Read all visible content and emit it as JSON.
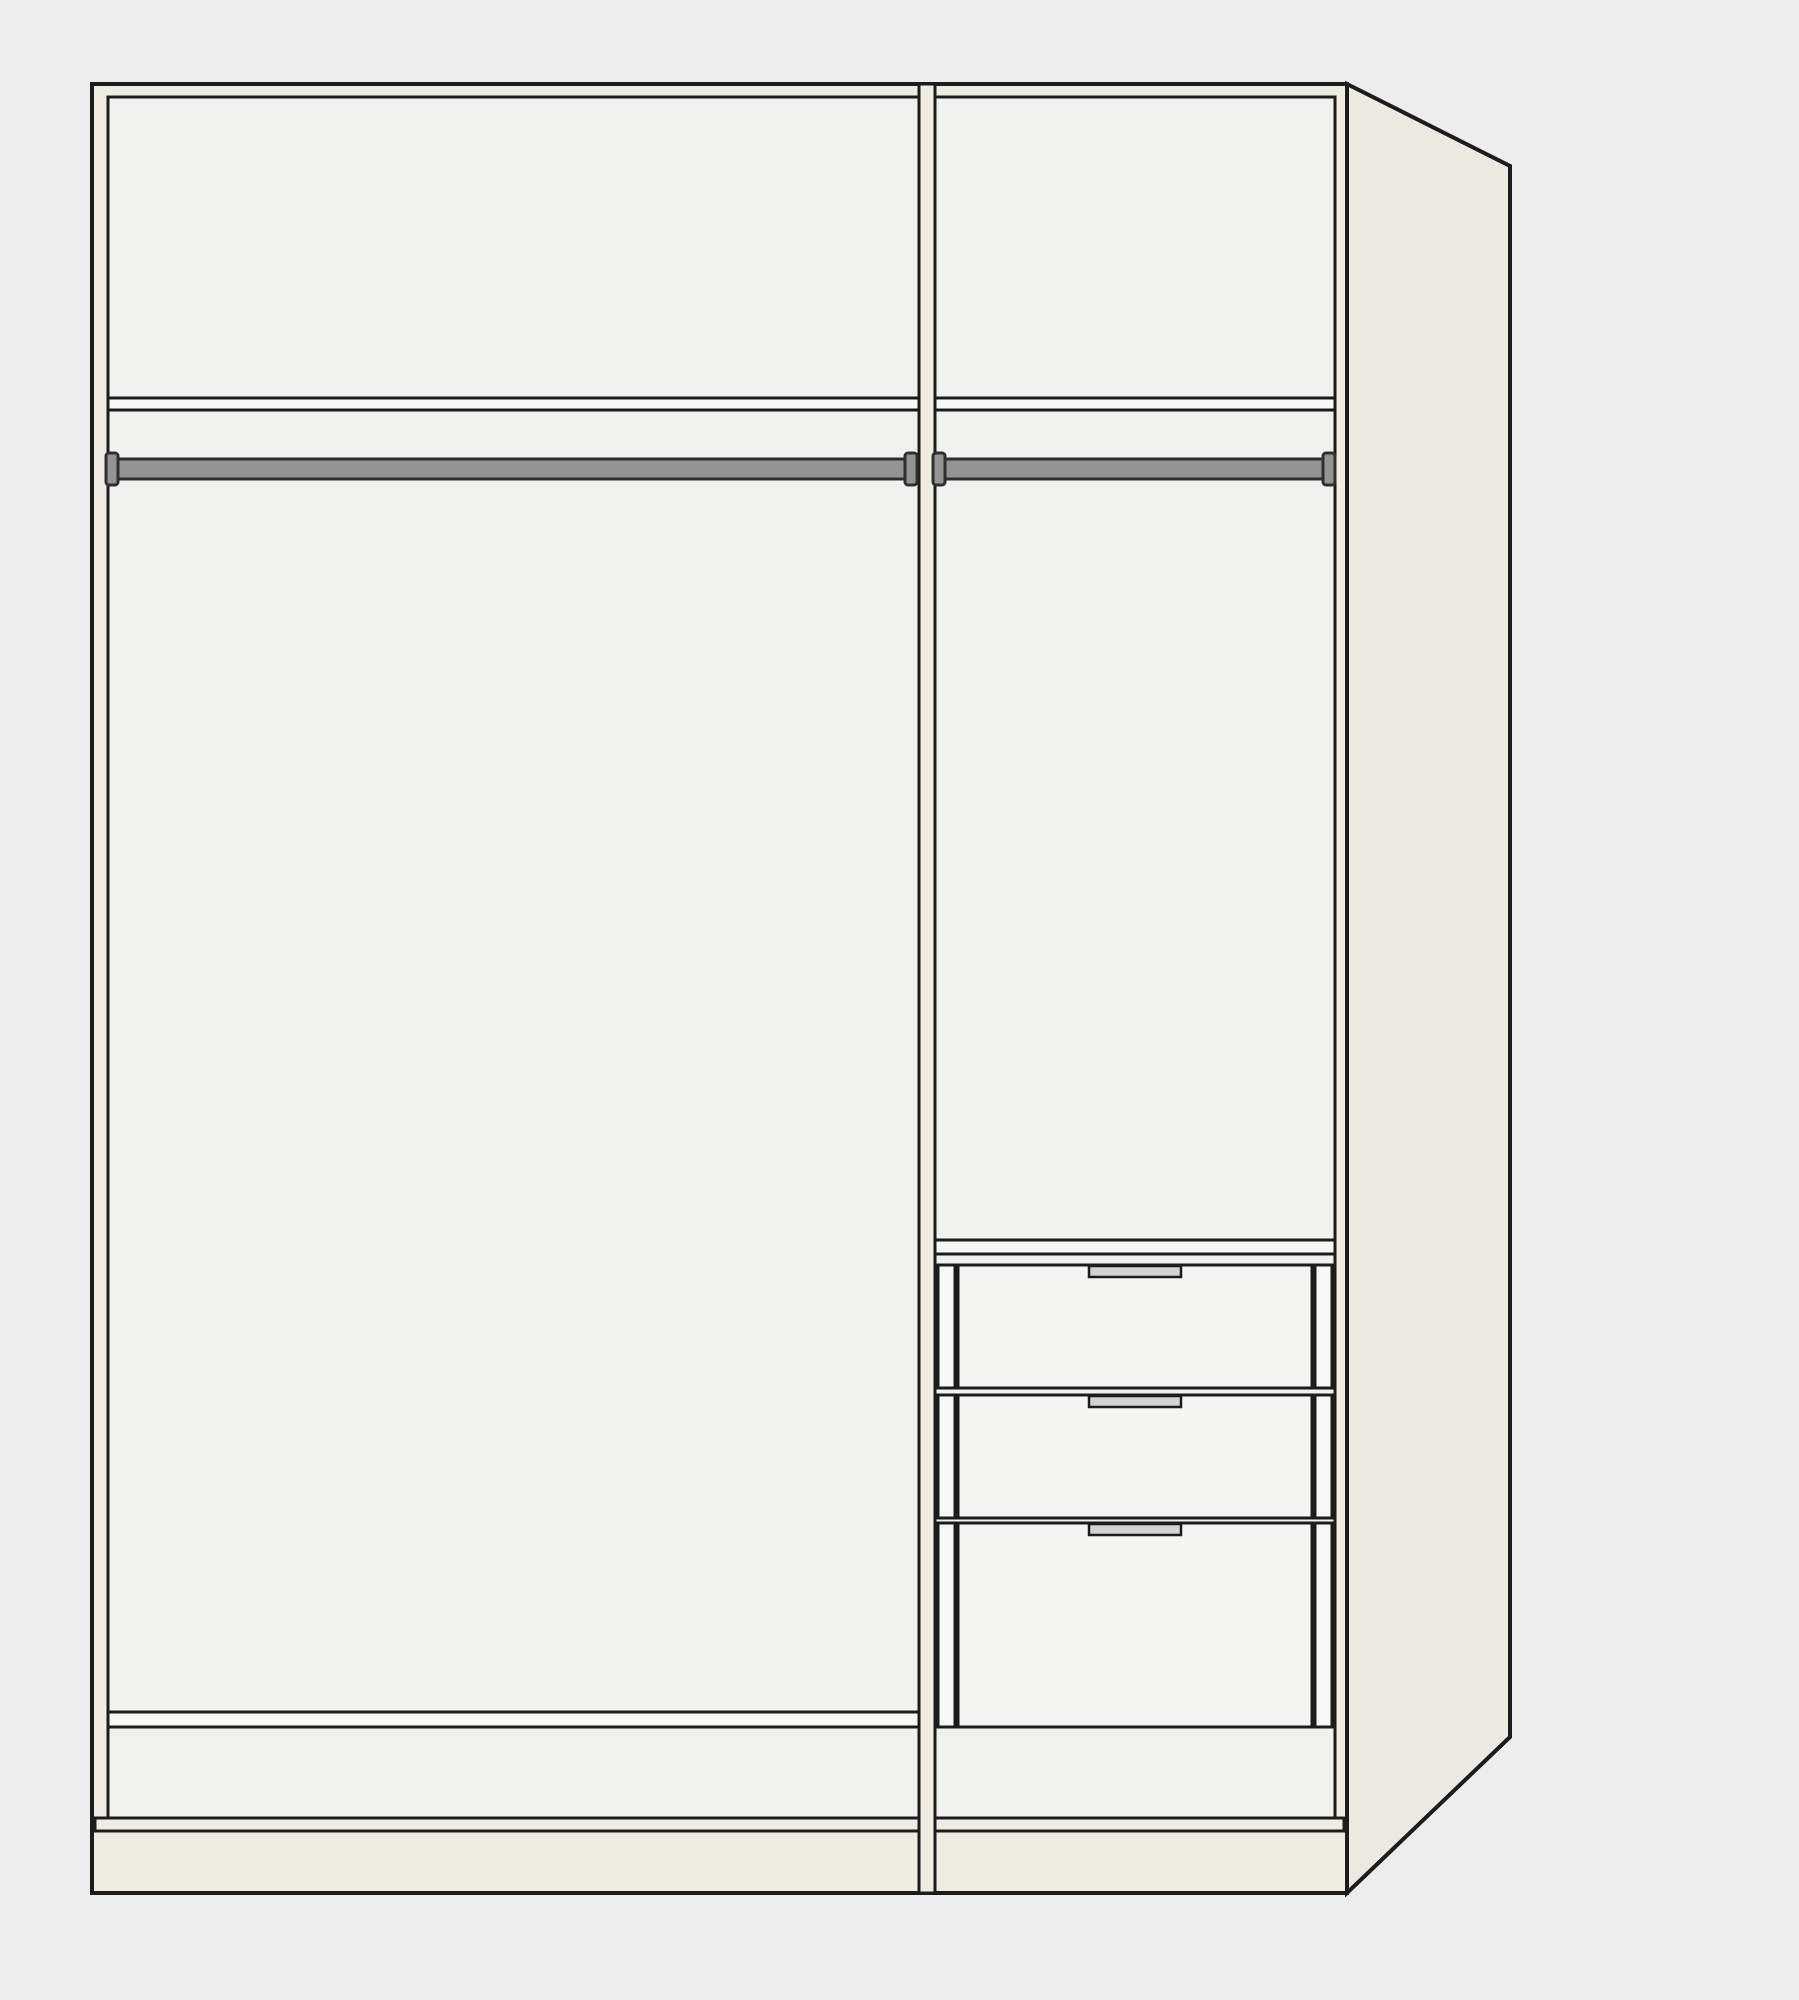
{
  "meta": {
    "drawing_type": "wardrobe-interior-configuration",
    "view": "front-with-right-side-perspective"
  },
  "colors": {
    "background": "#EDEDEE",
    "outline": "#1C1C1C",
    "frame": "#EFECE2",
    "side_panel": "#ECE9E0",
    "interior": "#F1F1F0",
    "board": "#F7F7F5",
    "drawer_front": "#F4F4F3",
    "rail": "#949494",
    "rail_edge": "#2F2F2F",
    "handle": "#D2D2D0"
  },
  "wardrobe": {
    "section_count": 2,
    "left_section": {
      "components": [
        "top-shelf",
        "clothes-rail",
        "bottom-shelf"
      ],
      "drawer_count": 0
    },
    "right_section": {
      "components": [
        "top-shelf",
        "clothes-rail",
        "drawer-unit"
      ],
      "drawer_count": 3,
      "drawers": [
        "drawer-1",
        "drawer-2",
        "drawer-3"
      ],
      "handle_style": "recessed-grip"
    }
  }
}
